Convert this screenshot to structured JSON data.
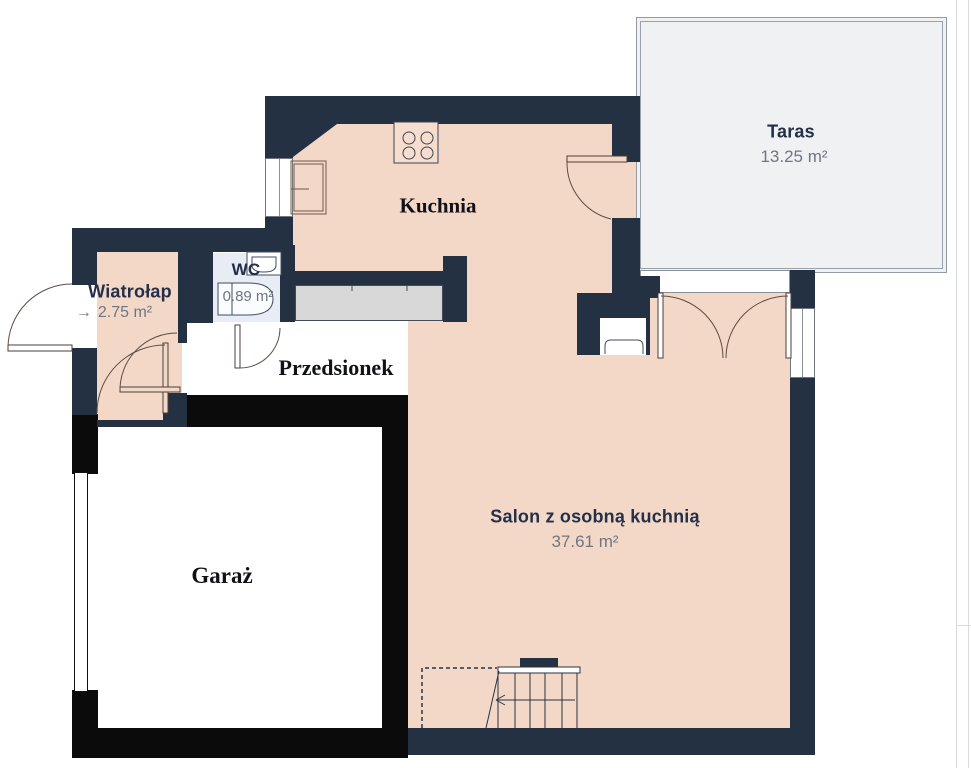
{
  "plan": {
    "title": "Rzut parteru",
    "rooms": {
      "taras": {
        "name": "Taras",
        "area": "13.25 m²"
      },
      "kuchnia": {
        "name": "Kuchnia"
      },
      "wc": {
        "name": "WC",
        "area": "0.89 m²"
      },
      "wiatrolap": {
        "name": "Wiatrołap",
        "area": "2.75 m²",
        "entry_arrow": "→"
      },
      "przedsionek": {
        "name": "Przedsionek"
      },
      "salon": {
        "name": "Salon z osobną kuchnią",
        "area": "37.61 m²"
      },
      "garaz": {
        "name": "Garaż"
      }
    },
    "colors": {
      "wall_navy": "#233143",
      "wall_garage_black": "#0b0b0c",
      "floor_main": "#f3d8c8",
      "floor_taras": "#f0f1f2",
      "floor_wc": "#e8ecf4",
      "floor_garage": "#ffffff",
      "counter_gray": "#d8d8d8",
      "label_navy": "#233049",
      "label_gray": "#6e7681",
      "door_arc": "#5f4c41"
    }
  }
}
